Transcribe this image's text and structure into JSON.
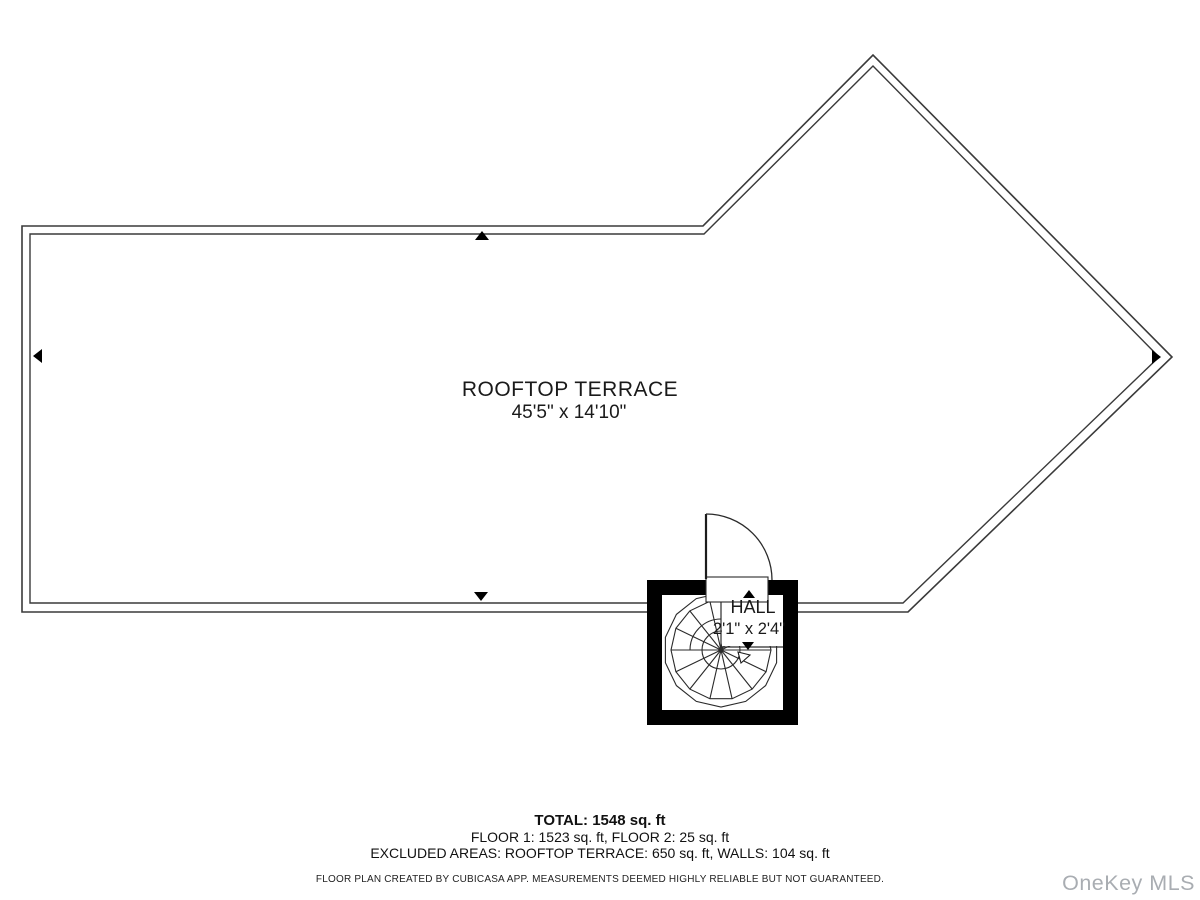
{
  "plan": {
    "terrace": {
      "label": "ROOFTOP TERRACE",
      "dimensions": "45'5\" x 14'10\""
    },
    "hall": {
      "label": "HALL",
      "dimensions": "2'1\" x 2'4\""
    }
  },
  "summary": {
    "total": "TOTAL: 1548 sq. ft",
    "floors": "FLOOR 1: 1523 sq. ft, FLOOR 2: 25 sq. ft",
    "excluded": "EXCLUDED AREAS: ROOFTOP TERRACE: 650 sq. ft, WALLS: 104 sq. ft",
    "disclaimer": "FLOOR PLAN CREATED BY CUBICASA APP. MEASUREMENTS DEEMED HIGHLY RELIABLE BUT NOT GUARANTEED."
  },
  "watermark": {
    "label": "OneKey MLS",
    "color": "#a9adb2"
  },
  "colors": {
    "wall_line": "#3a3a3a",
    "hall_wall": "#000000",
    "background": "#ffffff"
  }
}
